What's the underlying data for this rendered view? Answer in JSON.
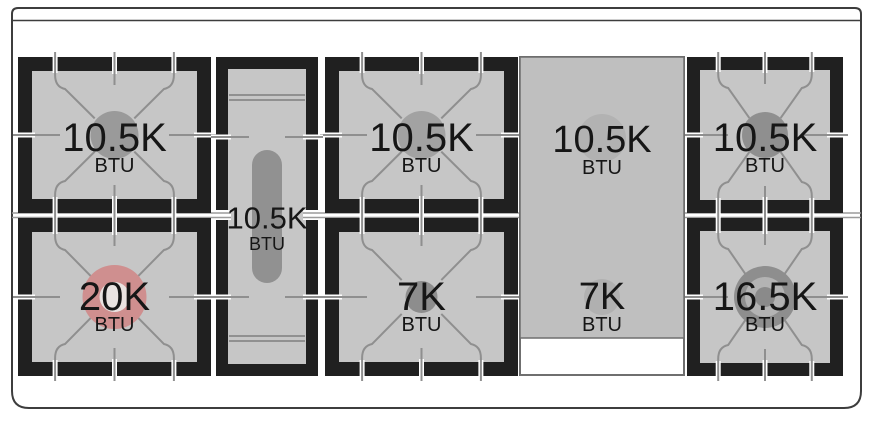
{
  "diagram": {
    "name": "gas-range-cooktop-burner-layout",
    "rows": 2,
    "burner_count": 9
  },
  "colors": {
    "background": "#ffffff",
    "frame": "#3d3d3d",
    "pad_black": "#202020",
    "surface_gray": "#c6c6c6",
    "grate_line": "#8f8f8f",
    "divider_line": "#9b9b9b",
    "burner_gray": "#9a9a9a",
    "oval_burner_gray": "#919191",
    "griddle_gray": "#bfbfbf",
    "griddle_border": "#6f6f6f",
    "griddle_burner_gray": "#b2b2b2",
    "power_burner_red": "#cf8f8f",
    "power_burner_inner": "#e9e3e1",
    "dual_ring_outer": "#8e8e8e",
    "dual_ring_ring": "#b3b3b3",
    "dual_ring_dot": "#8a8a8a",
    "text": "#161616"
  },
  "cooktop": {
    "burners": [
      {
        "id": "top-left",
        "btu": "10.5K",
        "unit": "BTU",
        "type": "standard"
      },
      {
        "id": "bottom-left",
        "btu": "20K",
        "unit": "BTU",
        "type": "power-dual-ring"
      },
      {
        "id": "center-oval",
        "btu": "10.5K",
        "unit": "BTU",
        "type": "oval"
      },
      {
        "id": "top-middle",
        "btu": "10.5K",
        "unit": "BTU",
        "type": "standard"
      },
      {
        "id": "bottom-middle",
        "btu": "7K",
        "unit": "BTU",
        "type": "standard"
      },
      {
        "id": "griddle-rear",
        "btu": "10.5K",
        "unit": "BTU",
        "type": "griddle"
      },
      {
        "id": "griddle-front",
        "btu": "7K",
        "unit": "BTU",
        "type": "griddle"
      },
      {
        "id": "top-right",
        "btu": "10.5K",
        "unit": "BTU",
        "type": "standard"
      },
      {
        "id": "bottom-right",
        "btu": "16.5K",
        "unit": "BTU",
        "type": "dual-ring"
      }
    ]
  }
}
